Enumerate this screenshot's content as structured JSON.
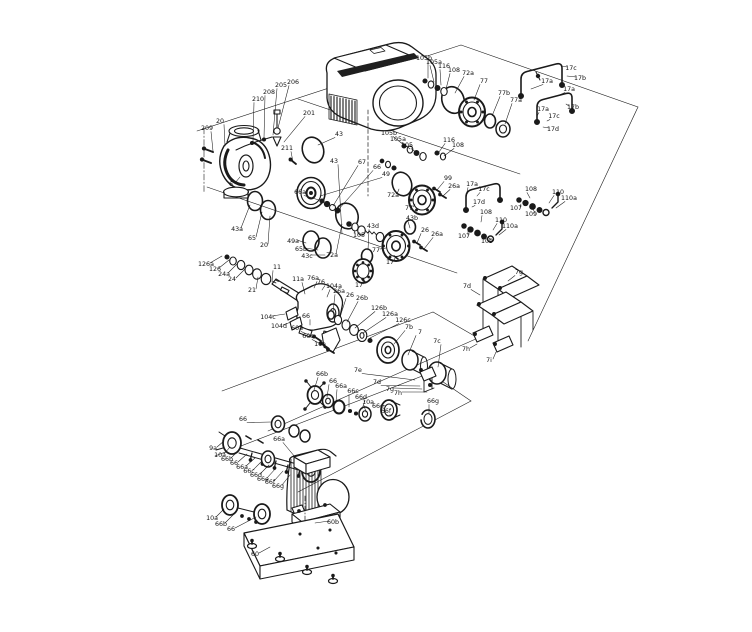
{
  "diagram": {
    "description": "exploded-parts-view-of-inline-pump-set",
    "bg": "#ffffff",
    "ink": "#1a1a1a",
    "callout_color": "#111111",
    "callouts": [
      [
        "209",
        207,
        130,
        213,
        151
      ],
      [
        "20",
        220,
        123,
        225,
        146
      ],
      [
        "210",
        258,
        101,
        253,
        141
      ],
      [
        "208",
        269,
        94,
        264,
        138
      ],
      [
        "205",
        281,
        87,
        273,
        135
      ],
      [
        "206",
        293,
        84,
        278,
        128
      ],
      [
        "201",
        309,
        115,
        284,
        142
      ],
      [
        "211",
        287,
        150,
        293,
        162
      ],
      [
        "6",
        231,
        186,
        240,
        177
      ],
      [
        "43",
        339,
        136,
        318,
        145
      ],
      [
        "43",
        334,
        163,
        342,
        234
      ],
      [
        "67",
        362,
        164,
        333,
        206
      ],
      [
        "66",
        377,
        169,
        338,
        210
      ],
      [
        "49",
        386,
        176,
        320,
        196
      ],
      [
        "66a",
        300,
        194,
        319,
        200
      ],
      [
        "43a",
        237,
        231,
        250,
        205
      ],
      [
        "65",
        252,
        240,
        262,
        212
      ],
      [
        "20",
        264,
        247,
        270,
        216
      ],
      [
        "49a",
        293,
        243,
        306,
        243
      ],
      [
        "65b",
        301,
        251,
        318,
        250
      ],
      [
        "43c",
        307,
        258,
        325,
        255
      ],
      [
        "105",
        359,
        237,
        354,
        230
      ],
      [
        "72a",
        332,
        257,
        342,
        224
      ],
      [
        "43d",
        373,
        228,
        368,
        250
      ],
      [
        "43b",
        412,
        220,
        410,
        228
      ],
      [
        "105b",
        424,
        60,
        428,
        78
      ],
      [
        "105a",
        434,
        64,
        434,
        82
      ],
      [
        "116",
        444,
        68,
        441,
        85
      ],
      [
        "108",
        454,
        72,
        446,
        89
      ],
      [
        "72a",
        468,
        75,
        455,
        93
      ],
      [
        "77",
        484,
        83,
        474,
        100
      ],
      [
        "77b",
        504,
        95,
        492,
        116
      ],
      [
        "77a",
        516,
        102,
        505,
        124
      ],
      [
        "17c",
        571,
        70,
        562,
        66
      ],
      [
        "17b",
        580,
        80,
        567,
        76
      ],
      [
        "17a",
        547,
        83,
        531,
        89
      ],
      [
        "17a",
        569,
        91,
        557,
        96
      ],
      [
        "17b",
        573,
        109,
        566,
        104
      ],
      [
        "17a",
        543,
        111,
        537,
        116
      ],
      [
        "17c",
        554,
        118,
        547,
        121
      ],
      [
        "17d",
        553,
        131,
        543,
        127
      ],
      [
        "105b",
        389,
        135,
        404,
        145
      ],
      [
        "105a",
        398,
        141,
        410,
        149
      ],
      [
        "105",
        407,
        147,
        417,
        153
      ],
      [
        "116",
        449,
        142,
        439,
        152
      ],
      [
        "108",
        458,
        147,
        444,
        156
      ],
      [
        "72a",
        393,
        197,
        399,
        189
      ],
      [
        "77",
        409,
        210,
        415,
        204
      ],
      [
        "99",
        448,
        180,
        437,
        190
      ],
      [
        "26a",
        454,
        188,
        443,
        196
      ],
      [
        "17a",
        472,
        186,
        467,
        192
      ],
      [
        "17c",
        484,
        191,
        477,
        196
      ],
      [
        "17d",
        479,
        204,
        472,
        207
      ],
      [
        "108",
        531,
        191,
        530,
        198
      ],
      [
        "110",
        558,
        194,
        549,
        203
      ],
      [
        "110a",
        569,
        200,
        556,
        208
      ],
      [
        "107",
        516,
        210,
        521,
        204
      ],
      [
        "109",
        531,
        216,
        533,
        209
      ],
      [
        "77",
        376,
        252,
        386,
        248
      ],
      [
        "17",
        390,
        264,
        395,
        258
      ],
      [
        "17",
        359,
        287,
        363,
        281
      ],
      [
        "26",
        425,
        232,
        417,
        243
      ],
      [
        "26a",
        437,
        236,
        424,
        249
      ],
      [
        "108",
        486,
        214,
        481,
        222
      ],
      [
        "110",
        501,
        222,
        493,
        230
      ],
      [
        "110a",
        510,
        228,
        499,
        235
      ],
      [
        "107",
        464,
        238,
        468,
        230
      ],
      [
        "109",
        487,
        243,
        488,
        237
      ],
      [
        "126a",
        206,
        266,
        222,
        256
      ],
      [
        "126",
        215,
        271,
        229,
        260
      ],
      [
        "24a",
        224,
        276,
        237,
        264
      ],
      [
        "24",
        232,
        281,
        245,
        269
      ],
      [
        "21",
        252,
        292,
        258,
        277
      ],
      [
        "11",
        277,
        269,
        272,
        282
      ],
      [
        "11a",
        298,
        281,
        305,
        294
      ],
      [
        "76a",
        313,
        280,
        314,
        288
      ],
      [
        "76",
        321,
        284,
        322,
        290
      ],
      [
        "104a",
        334,
        288,
        327,
        297
      ],
      [
        "104c",
        268,
        319,
        285,
        314
      ],
      [
        "104d",
        279,
        328,
        291,
        322
      ],
      [
        "66",
        306,
        318,
        310,
        325
      ],
      [
        "60a",
        297,
        330,
        316,
        338
      ],
      [
        "60c",
        308,
        338,
        323,
        345
      ],
      [
        "10a",
        320,
        346,
        330,
        350
      ],
      [
        "26a",
        339,
        293,
        333,
        312
      ],
      [
        "26",
        350,
        297,
        340,
        317
      ],
      [
        "26b",
        362,
        300,
        347,
        322
      ],
      [
        "126b",
        379,
        310,
        355,
        328
      ],
      [
        "126a",
        390,
        316,
        363,
        333
      ],
      [
        "126c",
        403,
        322,
        370,
        338
      ],
      [
        "7b",
        409,
        329,
        394,
        344
      ],
      [
        "7",
        420,
        334,
        408,
        355
      ],
      [
        "7c",
        437,
        343,
        438,
        367
      ],
      [
        "7e",
        358,
        372,
        415,
        380
      ],
      [
        "7d",
        377,
        384,
        420,
        386
      ],
      [
        "7g",
        390,
        391,
        422,
        389
      ],
      [
        "7h",
        398,
        395,
        427,
        392
      ],
      [
        "7g",
        519,
        274,
        508,
        281
      ],
      [
        "7d",
        467,
        288,
        480,
        295
      ],
      [
        "7h",
        466,
        351,
        477,
        344
      ],
      [
        "7i",
        489,
        362,
        496,
        352
      ],
      [
        "66b",
        322,
        376,
        314,
        390
      ],
      [
        "66",
        333,
        383,
        327,
        397
      ],
      [
        "66a",
        341,
        388,
        336,
        402
      ],
      [
        "66c",
        353,
        393,
        349,
        407
      ],
      [
        "66d",
        361,
        399,
        362,
        409
      ],
      [
        "10a",
        368,
        404,
        366,
        412
      ],
      [
        "66e",
        378,
        408,
        385,
        406
      ],
      [
        "66f",
        386,
        413,
        390,
        416
      ],
      [
        "66g",
        433,
        403,
        429,
        413
      ],
      [
        "66",
        243,
        421,
        271,
        422
      ],
      [
        "9a",
        213,
        450,
        224,
        441
      ],
      [
        "10a",
        220,
        457,
        230,
        447
      ],
      [
        "66b",
        227,
        461,
        239,
        450
      ],
      [
        "66",
        234,
        465,
        247,
        454
      ],
      [
        "66a",
        242,
        469,
        255,
        458
      ],
      [
        "66c",
        249,
        473,
        262,
        461
      ],
      [
        "66d",
        256,
        477,
        269,
        465
      ],
      [
        "66e",
        263,
        481,
        276,
        468
      ],
      [
        "66f",
        270,
        484,
        283,
        471
      ],
      [
        "66g",
        278,
        488,
        290,
        475
      ],
      [
        "66a",
        279,
        441,
        295,
        457
      ],
      [
        "10a",
        212,
        520,
        224,
        509
      ],
      [
        "66b",
        221,
        526,
        233,
        515
      ],
      [
        "66",
        231,
        531,
        256,
        517
      ],
      [
        "60b",
        333,
        524,
        315,
        523
      ],
      [
        "60",
        255,
        556,
        270,
        547
      ]
    ]
  }
}
